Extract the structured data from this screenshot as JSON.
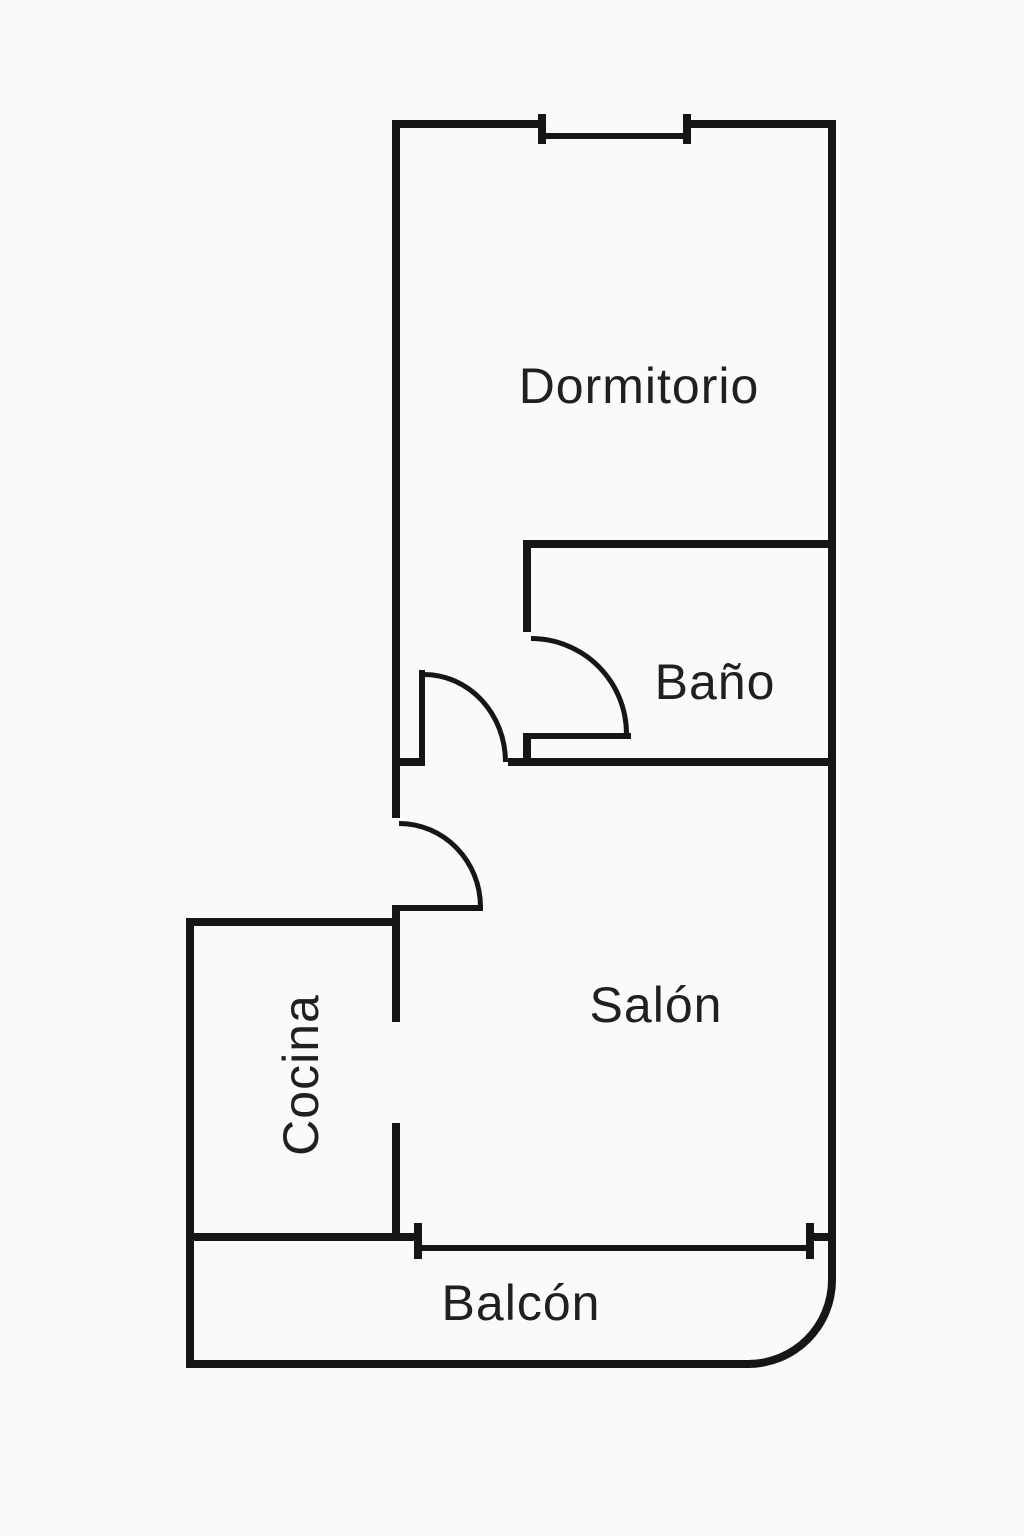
{
  "plan": {
    "type": "apartment-floor-plan",
    "colors": {
      "background": "#fafaf9",
      "wall": "#161616",
      "text": "#202020"
    },
    "rooms": [
      {
        "id": "dormitorio",
        "label": "Dormitorio"
      },
      {
        "id": "bano",
        "label": "Baño"
      },
      {
        "id": "salon",
        "label": "Salón"
      },
      {
        "id": "cocina",
        "label": "Cocina",
        "orientation": "vertical"
      },
      {
        "id": "balcon",
        "label": "Balcón"
      }
    ],
    "features": [
      {
        "id": "window-dormitorio",
        "type": "window",
        "location": "top wall"
      },
      {
        "id": "door-dormitorio",
        "type": "swing-door"
      },
      {
        "id": "door-bano",
        "type": "swing-door"
      },
      {
        "id": "door-salon",
        "type": "swing-door"
      },
      {
        "id": "opening-cocina",
        "type": "open-passage"
      },
      {
        "id": "opening-balcon",
        "type": "wide-opening"
      }
    ]
  }
}
